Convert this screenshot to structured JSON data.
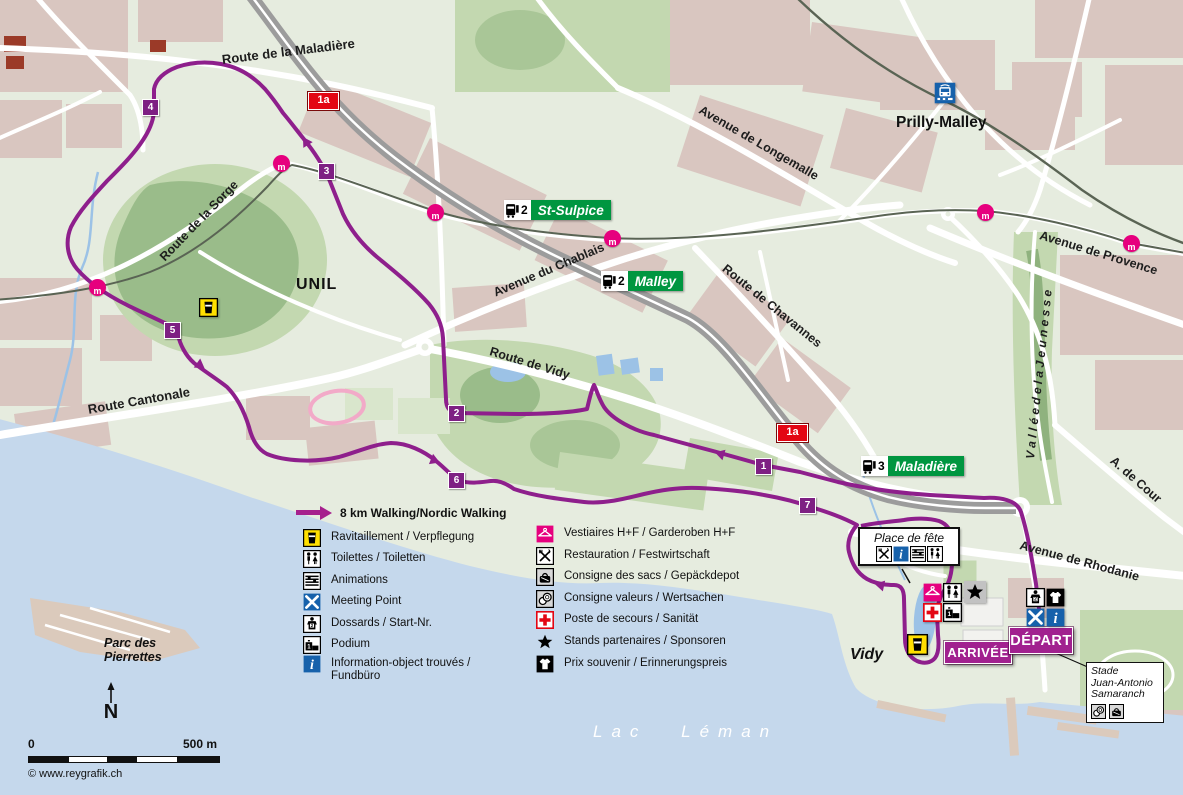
{
  "colors": {
    "route": "#8e1f8c",
    "km_badge": "#7e2083",
    "pink": "#e6007e",
    "transit_green": "#009640",
    "badge_red": "#e30613",
    "info_blue": "#1661ab",
    "ravitaillement_yellow": "#ffdf00",
    "lake": "#c5d8ec",
    "buildings": "#d9c6c0",
    "park": "#c3d8b0"
  },
  "legend": {
    "route_label": "8 km Walking/Nordic Walking",
    "columns": [
      [
        {
          "icon": "ravitaillement",
          "label": "Ravitaillement / Verpflegung"
        },
        {
          "icon": "toilettes",
          "label": "Toilettes / Toiletten"
        },
        {
          "icon": "animations",
          "label": "Animations"
        },
        {
          "icon": "meeting",
          "label": "Meeting Point"
        },
        {
          "icon": "dossards",
          "label": "Dossards / Start-Nr."
        },
        {
          "icon": "podium",
          "label": "Podium"
        },
        {
          "icon": "information",
          "label": "Information-object trouvés /\nFundbüro"
        }
      ],
      [
        {
          "icon": "vestiaires",
          "label": "Vestiaires H+F / Garderoben H+F"
        },
        {
          "icon": "restauration",
          "label": "Restauration / Festwirtschaft"
        },
        {
          "icon": "sacs",
          "label": "Consigne des sacs / Gepäckdepot"
        },
        {
          "icon": "valeurs",
          "label": "Consigne valeurs / Wertsachen"
        },
        {
          "icon": "secours",
          "label": "Poste de secours / Sanität"
        },
        {
          "icon": "stands",
          "label": "Stands partenaires / Sponsoren"
        },
        {
          "icon": "prix",
          "label": "Prix souvenir / Erinnerungspreis"
        }
      ]
    ],
    "col_x": [
      303,
      536
    ],
    "col_y": [
      [
        529,
        550,
        572,
        593,
        615,
        636,
        655
      ],
      [
        525,
        547,
        568,
        590,
        611,
        633,
        655
      ]
    ]
  },
  "streets": [
    {
      "t": "Route de la Maladière",
      "x": 222,
      "y": 52,
      "rot": -7,
      "fs": 13
    },
    {
      "t": "Route de la Sorge",
      "x": 162,
      "y": 252,
      "rot": -46,
      "fs": 12.5
    },
    {
      "t": "Route Cantonale",
      "x": 88,
      "y": 402,
      "rot": -10,
      "fs": 13
    },
    {
      "t": "Avenue du Chablais",
      "x": 494,
      "y": 286,
      "rot": -23,
      "fs": 12.5
    },
    {
      "t": "Route de Vidy",
      "x": 490,
      "y": 344,
      "rot": 17,
      "fs": 12.5
    },
    {
      "t": "Avenue de Longemalle",
      "x": 700,
      "y": 102,
      "rot": 30,
      "fs": 12.5
    },
    {
      "t": "Route de Chavannes",
      "x": 724,
      "y": 260,
      "rot": 39,
      "fs": 12.5
    },
    {
      "t": "Avenue de Provence",
      "x": 1040,
      "y": 228,
      "rot": 17,
      "fs": 12.5
    },
    {
      "t": "A. de Cour",
      "x": 1112,
      "y": 452,
      "rot": 41,
      "fs": 12.5
    },
    {
      "t": "Avenue de Rhodanie",
      "x": 1020,
      "y": 538,
      "rot": 15,
      "fs": 12.5
    },
    {
      "t": "V a l l é e   d e   l a   J e u n e s s e",
      "x": 1030,
      "y": 452,
      "rot": -84,
      "fs": 12,
      "it": true
    }
  ],
  "places": [
    {
      "id": "unil",
      "t": "UNIL",
      "x": 296,
      "y": 276,
      "fs": 16,
      "w": 600,
      "ls": 1
    },
    {
      "id": "prilly-malley",
      "t": "Prilly-Malley",
      "x": 896,
      "y": 114,
      "fs": 15.5,
      "w": 800
    },
    {
      "id": "vidy",
      "t": "Vidy",
      "x": 850,
      "y": 646,
      "fs": 16,
      "w": 600,
      "it": true
    },
    {
      "id": "parc-des-pierrettes",
      "t": "Parc des\nPierrettes",
      "x": 104,
      "y": 636,
      "fs": 12.5,
      "w": 600,
      "it": true
    }
  ],
  "lake_label": "Lac Léman",
  "transit_stops": [
    {
      "name": "St-Sulpice",
      "line": "2",
      "x": 504,
      "y": 200
    },
    {
      "name": "Malley",
      "line": "2",
      "x": 601,
      "y": 271
    },
    {
      "name": "Maladière",
      "line": "3",
      "x": 861,
      "y": 456
    }
  ],
  "road_badges": [
    {
      "text": "1a",
      "x": 308,
      "y": 92
    },
    {
      "text": "1a",
      "x": 777,
      "y": 424
    }
  ],
  "km_markers": [
    {
      "n": "1",
      "cx": 763,
      "cy": 466
    },
    {
      "n": "2",
      "cx": 456,
      "cy": 413
    },
    {
      "n": "3",
      "cx": 326,
      "cy": 171
    },
    {
      "n": "4",
      "cx": 150,
      "cy": 107
    },
    {
      "n": "5",
      "cx": 172,
      "cy": 330
    },
    {
      "n": "6",
      "cx": 456,
      "cy": 480
    },
    {
      "n": "7",
      "cx": 807,
      "cy": 505
    }
  ],
  "metro_stations": [
    {
      "x": 97,
      "y": 287
    },
    {
      "x": 281,
      "y": 163
    },
    {
      "x": 435,
      "y": 212
    },
    {
      "x": 612,
      "y": 238
    },
    {
      "x": 985,
      "y": 212
    },
    {
      "x": 1131,
      "y": 243
    }
  ],
  "metro_station_glyph": "m",
  "banners": [
    {
      "id": "arrivee",
      "text": "ARRIVÉE",
      "x": 944,
      "y": 641,
      "w": 66,
      "h": 21,
      "fs": 13
    },
    {
      "id": "depart",
      "text": "DÉPART",
      "x": 1009,
      "y": 627,
      "w": 62,
      "h": 25,
      "fs": 14.5
    }
  ],
  "fete_box": {
    "label": "Place de fête",
    "x": 858,
    "y": 527,
    "w": 92,
    "icons": [
      "restauration",
      "information",
      "animations",
      "toilettes"
    ]
  },
  "stade_box": {
    "lines": "Stade\nJuan-Antonio\nSamaranch",
    "x": 1086,
    "y": 662,
    "w": 68,
    "icons": [
      "valeurs",
      "sacs"
    ]
  },
  "icon_clusters": [
    {
      "x": 923,
      "y": 583,
      "rows": [
        [
          "vestiaires",
          "toilettes"
        ],
        [
          "secours",
          "podium"
        ]
      ]
    },
    {
      "x": 1026,
      "y": 588,
      "rows": [
        [
          "dossards",
          "prix"
        ],
        [
          "meeting",
          "information"
        ]
      ]
    }
  ],
  "single_icons": [
    {
      "icon": "ravitaillement",
      "x": 199,
      "y": 298,
      "s": 19
    },
    {
      "icon": "ravitaillement",
      "x": 907,
      "y": 634,
      "s": 21
    },
    {
      "icon": "stands",
      "x": 964,
      "y": 581,
      "s": 20,
      "bg": "#c2c2c2"
    },
    {
      "icon": "station",
      "x": 934,
      "y": 82,
      "s": 22
    }
  ],
  "north_label": "N",
  "scale": {
    "start": "0",
    "end": "500 m"
  },
  "copyright": "© www.reygrafik.ch"
}
